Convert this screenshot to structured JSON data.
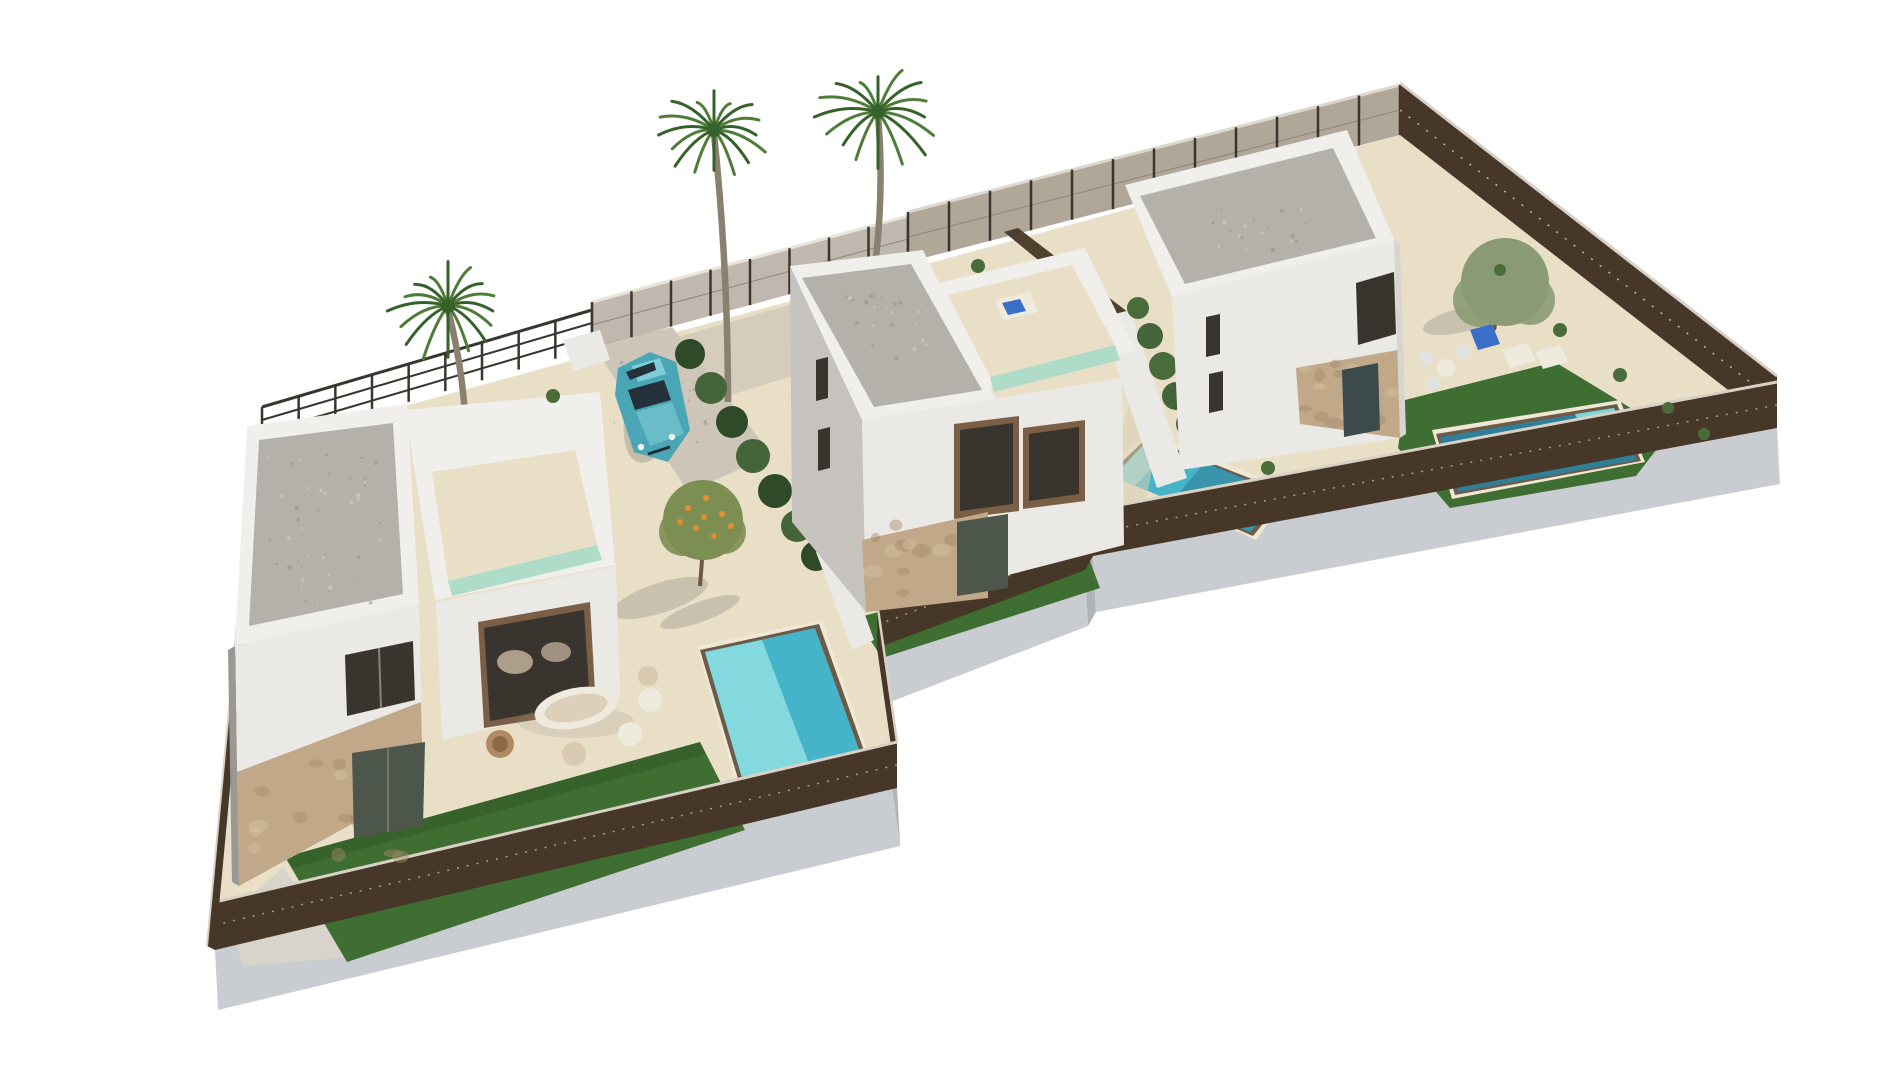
{
  "canvas": {
    "width": 1900,
    "height": 1069,
    "background": "#ffffff"
  },
  "palette": {
    "background": "#ffffff",
    "slab_side": "#c9ccd0",
    "slab_side_dark": "#b0b4b8",
    "paving": "#e9dfc7",
    "paving_shade": "#d9cdb2",
    "gravel_drive": "#cdc6b8",
    "concrete_path": "#d8d4cb",
    "gravel_roof": "#b4b1aa",
    "parapet_white": "#f1efec",
    "wall_lit": "#ebe9e5",
    "wall_medium": "#d8d5d1",
    "wall_shade": "#c6c3bf",
    "wall_dark": "#9b9894",
    "stone": "#c0a888",
    "stone_dark": "#a58a6a",
    "window_dark": "#3a342e",
    "window_frame": "#7a5f46",
    "glass_green": "#4d564a",
    "glass_teal": "#3d4a4a",
    "curtain": "#cbb9a2",
    "lawn": "#3f6e33",
    "lawn_dark": "#2f5526",
    "pool_water": "#45b4c8",
    "pool_water_light": "#8fdfe2",
    "pool_water_dark": "#2f7f98",
    "pool_steps": "#7fd4d8",
    "pool_rim": "#6b5b48",
    "pool_coping": "#f0e8d4",
    "roof_pool_edge": "#aedcc9",
    "fence_dark": "#473728",
    "fence_rail_light": "#d8d2c6",
    "fence_mesh_light": "#b5aca0",
    "fence_mesh_panel": "#a79d8e",
    "fence_rail_dark": "#3a352f",
    "hedge": "#2f4a28",
    "hedge_light": "#44643a",
    "bush": "#4a6b3a",
    "palm_frond": "#4f7c39",
    "palm_frond_dark": "#35612a",
    "palm_trunk": "#8a8070",
    "tree_olive": "#8a9a74",
    "tree_orange_foliage": "#7d8e52",
    "orange_fruit": "#e09030",
    "trunk_brown": "#6b5744",
    "car_body": "#4aa6b5",
    "car_body_light": "#7fcdd6",
    "car_glass": "#22313a",
    "furniture_beige": "#d8c9b0",
    "furniture_white": "#efeade",
    "furniture_brown": "#b08a62",
    "lounger_blue": "#3a6fc9",
    "shadow": "#8e8a80",
    "speckle_dark": "#8f8b84",
    "speckle_light": "#d8d5cf"
  },
  "scene": {
    "type": "3d-architectural-render",
    "view": "aerial isometric",
    "description": "Aerial 3D render of three modern white two-storey villas on a shared fenced plot, each with flat gravel roof, roof terrace, stone-clad ground floor, private turquoise pool, artificial lawn and cream paving; a teal hatchback is parked in the left villa driveway; palm trees and small garden trees around; white background.",
    "villas": [
      {
        "name": "villa-1",
        "position": "left",
        "features": [
          "flat gravel roof",
          "roof terrace with water edge",
          "stone-clad ground floor",
          "large glazed lounge window",
          "private pool",
          "lawn strip",
          "outdoor lounge set",
          "driveway with parked car",
          "palm tree",
          "orange tree"
        ]
      },
      {
        "name": "villa-2",
        "position": "middle",
        "features": [
          "flat gravel roof",
          "roof terrace with sun lounger",
          "stone-clad ground floor",
          "two dark framed windows",
          "private pool",
          "lawn strip",
          "palm tree",
          "hedge boundary"
        ]
      },
      {
        "name": "villa-3",
        "position": "right",
        "features": [
          "flat gravel roof",
          "stone-clad ground floor",
          "private pool with steps",
          "wrap-around lawn",
          "sun loungers",
          "garden table with chairs",
          "olive tree",
          "palm tree",
          "shrub border"
        ]
      }
    ],
    "vehicle": {
      "name": "car",
      "kind": "teal hatchback",
      "location": "villa-1 driveway"
    },
    "site": {
      "boundary": "dark brown mesh fence with light top rail and grey mesh street panels",
      "base": "raised concrete platform",
      "ground": "cream paving and gravel"
    }
  }
}
